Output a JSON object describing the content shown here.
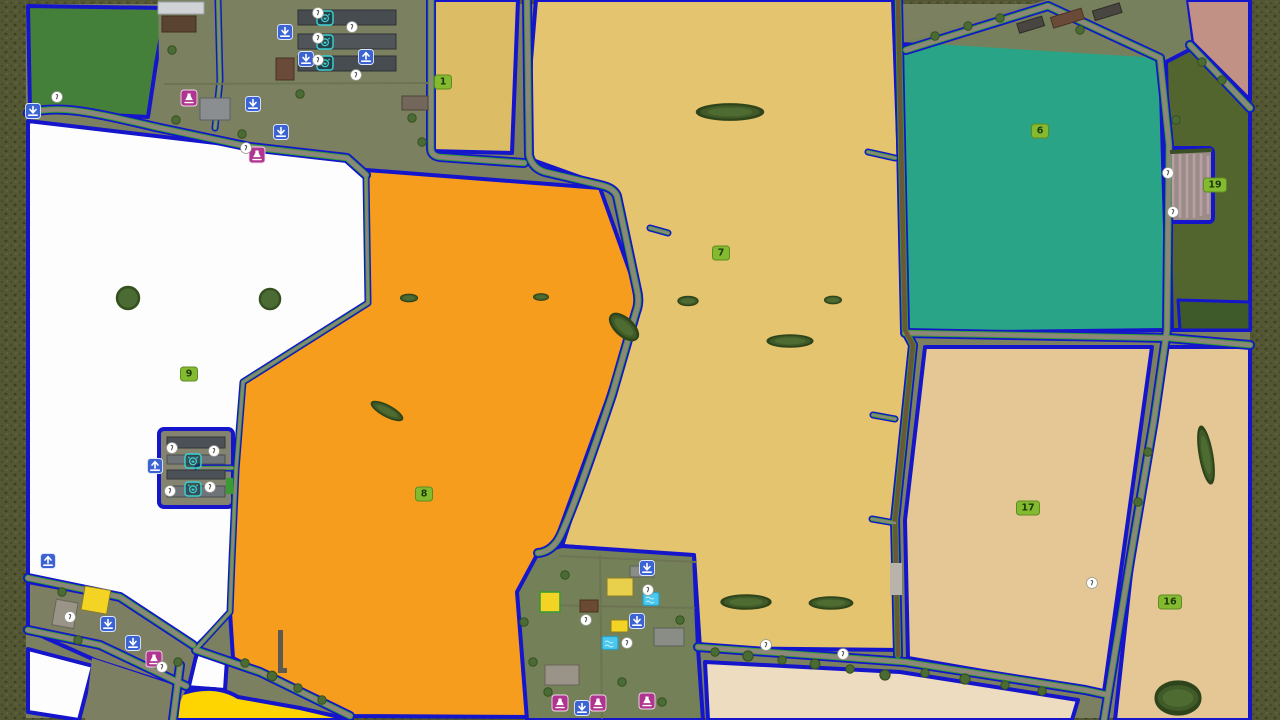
{
  "map": {
    "name": "farm-overview-map",
    "fields": {
      "f1": "1",
      "f6": "6",
      "f7": "7",
      "f8": "8",
      "f9": "9",
      "f16": "16",
      "f17": "17",
      "f19": "19"
    },
    "markers": {
      "sell": "sell-point-icon",
      "load": "load-point-icon",
      "production": "production-point-icon",
      "poi": "point-of-interest-icon",
      "animal": "pig-pen-icon",
      "pool": "pool-icon"
    }
  },
  "colors": {
    "border_olive": "#545733",
    "terrain": "#7b8061",
    "terrain_dark": "#6d7453",
    "field_border": "#1515cb",
    "field_khaki": "#dcbd66",
    "field_tan": "#e5c46f",
    "field_orange": "#f79d1d",
    "field_teal": "#2aa487",
    "field_white": "#fdfdfd",
    "field_beige": "#e4c795",
    "field_beige_light": "#eedcc0",
    "field_yellow": "#fed501",
    "field_green_dark": "#45803b",
    "field_olive_green": "#53652f",
    "pond_green": "#3e5a2a",
    "field_pink": "#c29186",
    "road_gray": "#8d8779",
    "road_dirt": "#6e5736",
    "road_green": "#2f9c33",
    "badge_bg": "#84ba30",
    "badge_border": "#5d8c1f",
    "badge_text": "#1c3a0c",
    "icon_blue": "#3c63d2",
    "icon_magenta": "#b03590",
    "icon_teal": "#3bd3d8",
    "pool_cyan": "#49c7ee",
    "hedge_green": "#415b28",
    "tree_green": "#4b6b35"
  }
}
